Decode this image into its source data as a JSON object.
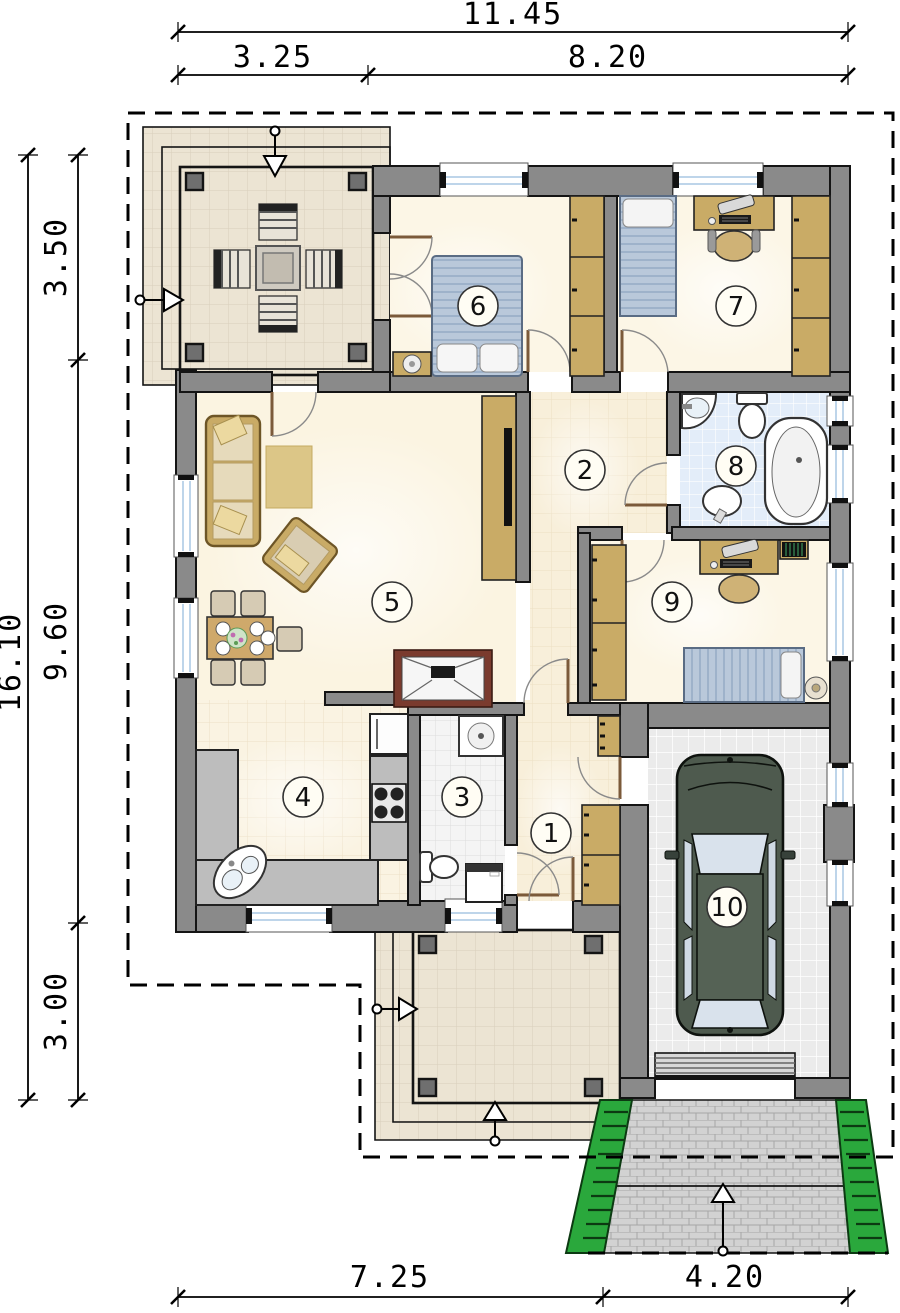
{
  "dimensions": {
    "top_total": "11.45",
    "top_segment_left": "3.25",
    "top_segment_right": "8.20",
    "left_total": "16.10",
    "left_segment_top": "3.50",
    "left_segment_middle": "9.60",
    "left_segment_bottom": "3.00",
    "bottom_segment_left": "7.25",
    "bottom_segment_right": "4.20"
  },
  "rooms": [
    {
      "number": "1"
    },
    {
      "number": "2"
    },
    {
      "number": "3"
    },
    {
      "number": "4"
    },
    {
      "number": "5"
    },
    {
      "number": "6"
    },
    {
      "number": "7"
    },
    {
      "number": "8"
    },
    {
      "number": "9"
    },
    {
      "number": "10"
    }
  ],
  "colors": {
    "wall": "#8a8a8a",
    "floor_cream": "#f8efda",
    "terrace_tile": "#ece4d3",
    "bathroom_tile": "#e3edf9",
    "garage_floor": "#ebebeb",
    "wood_furniture": "#c9ab66",
    "bed_fabric": "#b9c8da",
    "hedge_green": "#2aa83c",
    "car_green": "#4e5a4e",
    "driveway_paving": "#d2d2d2",
    "fireplace_brick": "#7a3b2e",
    "window_glass": "#a9c7e4",
    "dimension_text": "#000000"
  }
}
